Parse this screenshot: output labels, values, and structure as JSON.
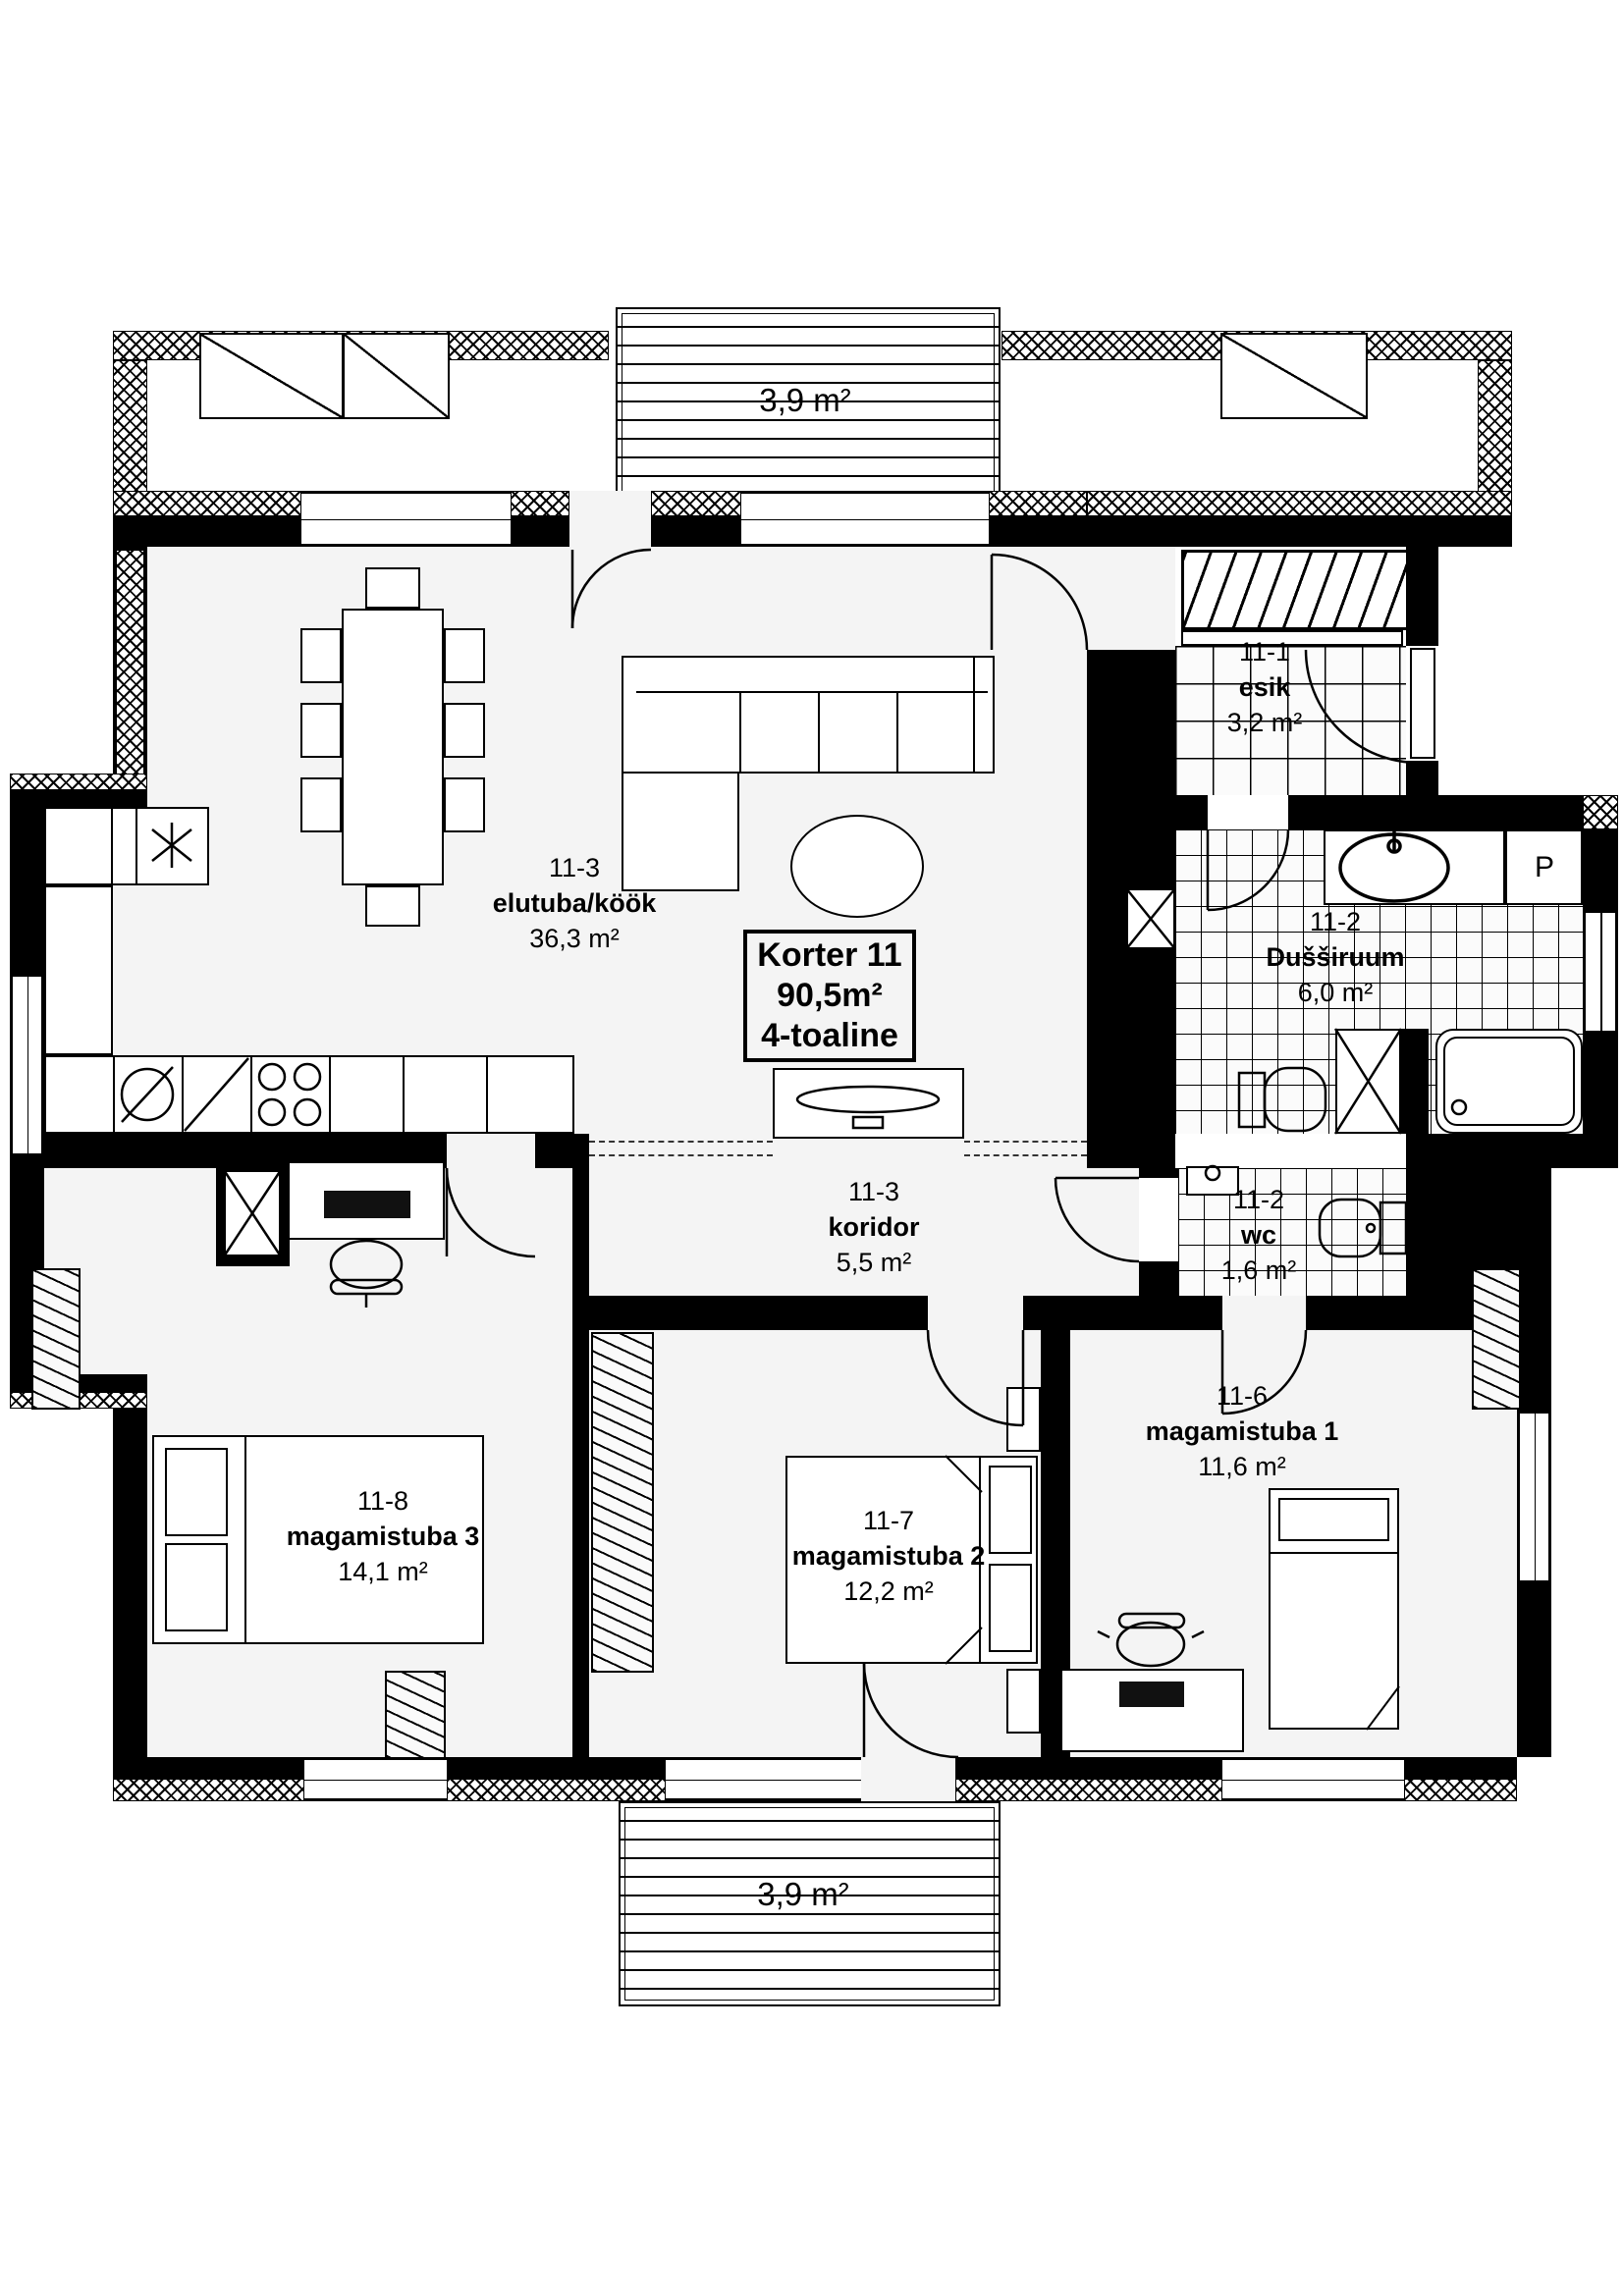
{
  "title_box": {
    "line1": "Korter 11",
    "line2": "90,5m²",
    "line3": "4-toaline"
  },
  "balconies": {
    "top": "3,9 m²",
    "bottom": "3,9 m²"
  },
  "rooms": [
    {
      "id": "elutuba",
      "code": "11-3",
      "name": "elutuba/köök",
      "area": "36,3 m²"
    },
    {
      "id": "esik",
      "code": "11-1",
      "name": "esik",
      "area": "3,2 m²"
    },
    {
      "id": "dussiruum",
      "code": "11-2",
      "name": "Dušširuum",
      "area": "6,0 m²"
    },
    {
      "id": "wc",
      "code": "11-2",
      "name": "wc",
      "area": "1,6 m²"
    },
    {
      "id": "koridor",
      "code": "11-3",
      "name": "koridor",
      "area": "5,5 m²"
    },
    {
      "id": "magamistuba1",
      "code": "11-6",
      "name": "magamistuba 1",
      "area": "11,6 m²"
    },
    {
      "id": "magamistuba2",
      "code": "11-7",
      "name": "magamistuba 2",
      "area": "12,2 m²"
    },
    {
      "id": "magamistuba3",
      "code": "11-8",
      "name": "magamistuba 3",
      "area": "14,1 m²"
    }
  ],
  "appliances": {
    "washing_machine_label": "P"
  },
  "colors": {
    "wall": "#000000",
    "floor": "#f4f4f4",
    "background": "#ffffff"
  }
}
